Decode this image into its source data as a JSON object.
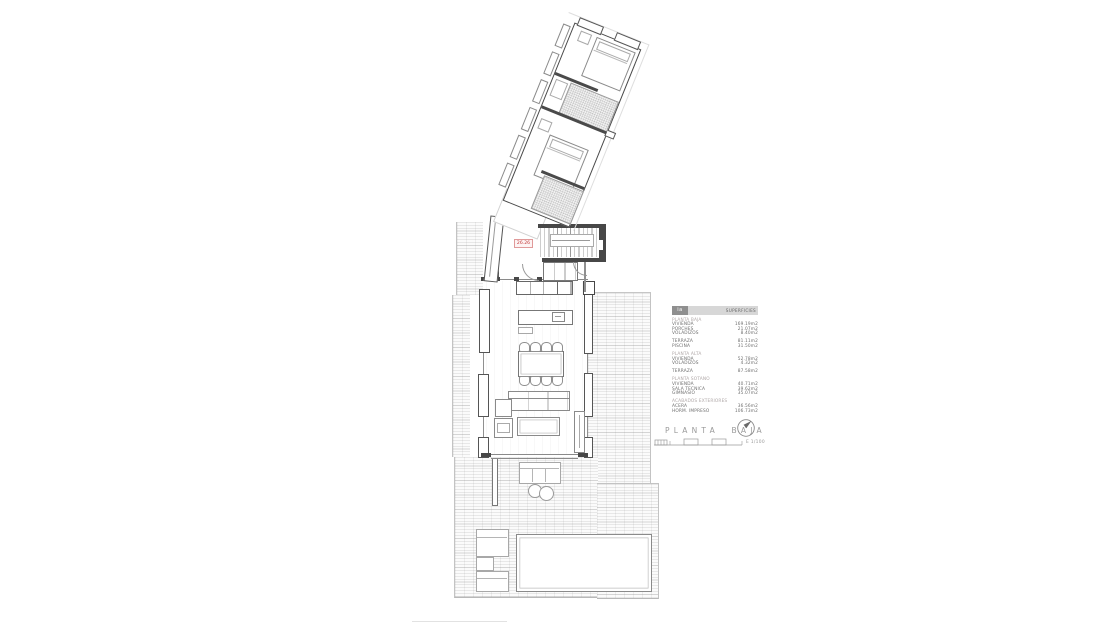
{
  "plan": {
    "title": "PLANTA BAJA",
    "scale_label": "E 1/100",
    "level_label": "26.26"
  },
  "surface_table": {
    "header": {
      "logo": "ia",
      "title": "SUPERFICIES"
    },
    "sections": [
      {
        "name": "PLANTA BAJA",
        "rows": [
          [
            "VIVIENDA",
            "169.19m2"
          ],
          [
            "PORCHES",
            "21.07m2"
          ],
          [
            "VOLADIZOS",
            "8.40m2"
          ]
        ]
      },
      {
        "name": "",
        "rows": [
          [
            "TERRAZA",
            "81.11m2"
          ],
          [
            "PISCINA",
            "31.50m2"
          ]
        ]
      },
      {
        "name": "PLANTA ALTA",
        "rows": [
          [
            "VIVIENDA",
            "52.78m2"
          ],
          [
            "VOLADIZOS",
            "4.32m2"
          ]
        ]
      },
      {
        "name": "",
        "rows": [
          [
            "TERRAZA",
            "87.58m2"
          ]
        ]
      },
      {
        "name": "PLANTA SOTANO",
        "rows": [
          [
            "VIVIENDA",
            "40.71m2"
          ],
          [
            "SALA TECNICA",
            "39.62m2"
          ],
          [
            "GIMNASIO",
            "35.07m2"
          ]
        ]
      },
      {
        "name": "ACABADOS EXTERIORES",
        "rows": [
          [
            "ACERA",
            "36.56m2"
          ],
          [
            "HORM. IMPRESO",
            "106.73m2"
          ]
        ]
      }
    ]
  },
  "colors": {
    "wall": "#474747",
    "line": "#8a8a8a",
    "accent_red": "#c33b3b",
    "hatch": "#d8d8d8"
  }
}
